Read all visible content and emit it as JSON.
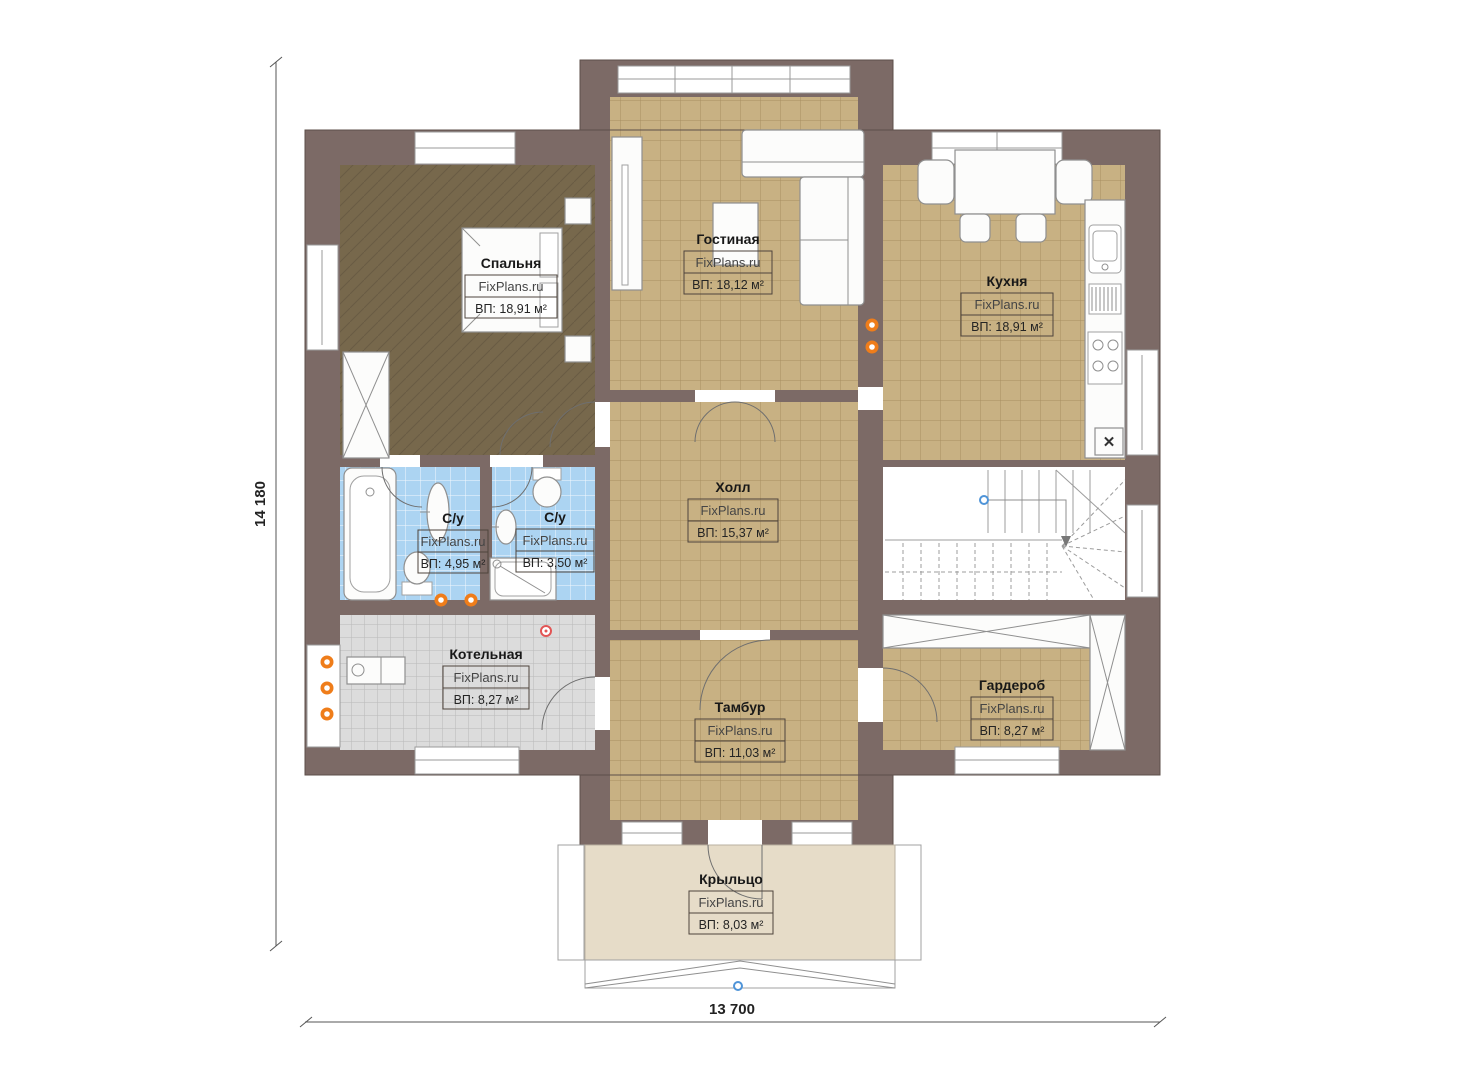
{
  "plan": {
    "watermark": "FixPlans.ru",
    "dimensions": {
      "left": "14 180",
      "bottom": "13 700"
    },
    "symbols": {
      "x_marker": "✕"
    },
    "rooms": [
      {
        "id": "bedroom",
        "name": "Спальня",
        "watermark": "FixPlans.ru",
        "area": "ВП: 18,91 м²"
      },
      {
        "id": "living",
        "name": "Гостиная",
        "watermark": "FixPlans.ru",
        "area": "ВП: 18,12 м²"
      },
      {
        "id": "kitchen",
        "name": "Кухня",
        "watermark": "FixPlans.ru",
        "area": "ВП: 18,91 м²"
      },
      {
        "id": "hall",
        "name": "Холл",
        "watermark": "FixPlans.ru",
        "area": "ВП: 15,37 м²"
      },
      {
        "id": "bath1",
        "name": "С/у",
        "watermark": "FixPlans.ru",
        "area": "ВП: 4,95 м²"
      },
      {
        "id": "bath2",
        "name": "С/у",
        "watermark": "FixPlans.ru",
        "area": "ВП: 3,50 м²"
      },
      {
        "id": "boiler",
        "name": "Котельная",
        "watermark": "FixPlans.ru",
        "area": "ВП: 8,27 м²"
      },
      {
        "id": "vestibule",
        "name": "Тамбур",
        "watermark": "FixPlans.ru",
        "area": "ВП: 11,03 м²"
      },
      {
        "id": "wardrobe",
        "name": "Гардероб",
        "watermark": "FixPlans.ru",
        "area": "ВП: 8,27 м²"
      },
      {
        "id": "porch",
        "name": "Крыльцо",
        "watermark": "FixPlans.ru",
        "area": "ВП: 8,03 м²"
      }
    ],
    "colors": {
      "wall": "#7c6a66",
      "floor_tan": "#c8b183",
      "floor_tan_line": "#a78e61",
      "floor_dark": "#77684c",
      "floor_blue": "#acd4f2",
      "floor_gray": "#dcdcdc",
      "floor_gray_line": "#b9b9b9",
      "porch": "#e6dcc8",
      "radiator": "#ef7d1a",
      "detector": "#e25555",
      "marker_blue": "#4f94d8"
    }
  }
}
